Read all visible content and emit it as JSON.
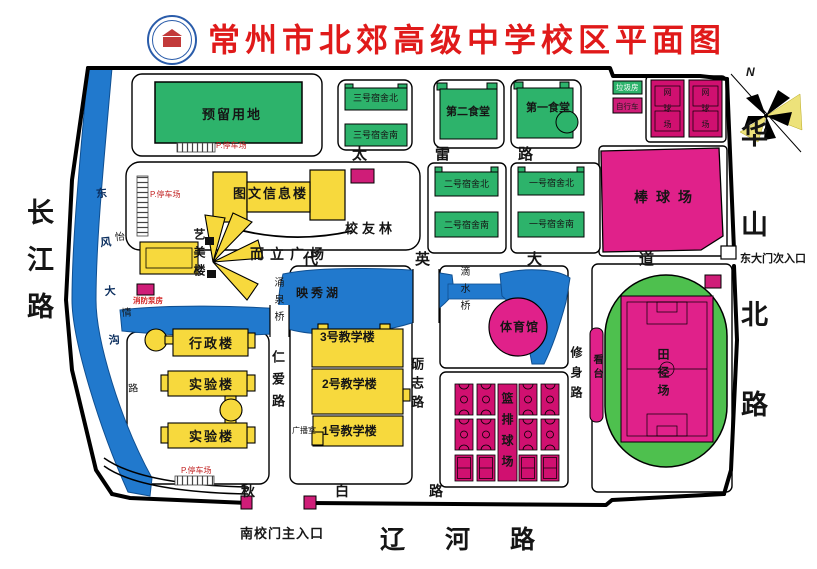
{
  "title": "常州市北郊高级中学校区平面图",
  "compass": {
    "north": "N"
  },
  "roads": {
    "changjiang": "长江路",
    "huashanbei": "华山北路",
    "liaohe": "辽河路",
    "tailei": "太雷路",
    "daiying": "代英大道",
    "renai": "仁爱路",
    "lizhi": "砺志路",
    "xiushen": "修身路",
    "qiubai": "秋白路",
    "yiqing": "怡情路",
    "dongfengdagou": "东风大沟"
  },
  "bridges": {
    "yongquan": "涌泉桥",
    "dishui": "滴水桥"
  },
  "water": {
    "lake": "映秀湖"
  },
  "gates": {
    "south": "南校门主入口",
    "east": "东大门次入口"
  },
  "places": {
    "plaza": "而立广场",
    "alumni_grove": "校友林",
    "reserved_land": "预留用地"
  },
  "buildings": {
    "library": "图文信息楼",
    "art": "艺美楼",
    "admin": "行政楼",
    "lab": "实验楼",
    "teach3": "3号教学楼",
    "teach2": "2号教学楼",
    "teach1": "1号教学楼",
    "dorm3n": "三号宿舍北",
    "dorm3s": "三号宿舍南",
    "dorm2n": "二号宿舍北",
    "dorm2s": "二号宿舍南",
    "dorm1n": "一号宿舍北",
    "dorm1s": "一号宿舍南",
    "canteen2": "第二食堂",
    "canteen1": "第一食堂",
    "broadcast": "广播室",
    "pump": "消防泵房",
    "trash": "垃圾房",
    "bike": "自行车",
    "gym": "体育馆"
  },
  "sports": {
    "baseball": "棒球场",
    "track": "田径场",
    "stand": "看台",
    "courts": "篮排球场",
    "tennis": "网球场"
  },
  "parking": {
    "label": "P.停车场"
  },
  "colors": {
    "title_red": "#e01a1a",
    "building_yellow": "#f7d93d",
    "green_building": "#2db36b",
    "field_magenta": "#e0218a",
    "court_magenta": "#d01070",
    "water_blue": "#2179cd",
    "track_green": "#4ec04e"
  }
}
